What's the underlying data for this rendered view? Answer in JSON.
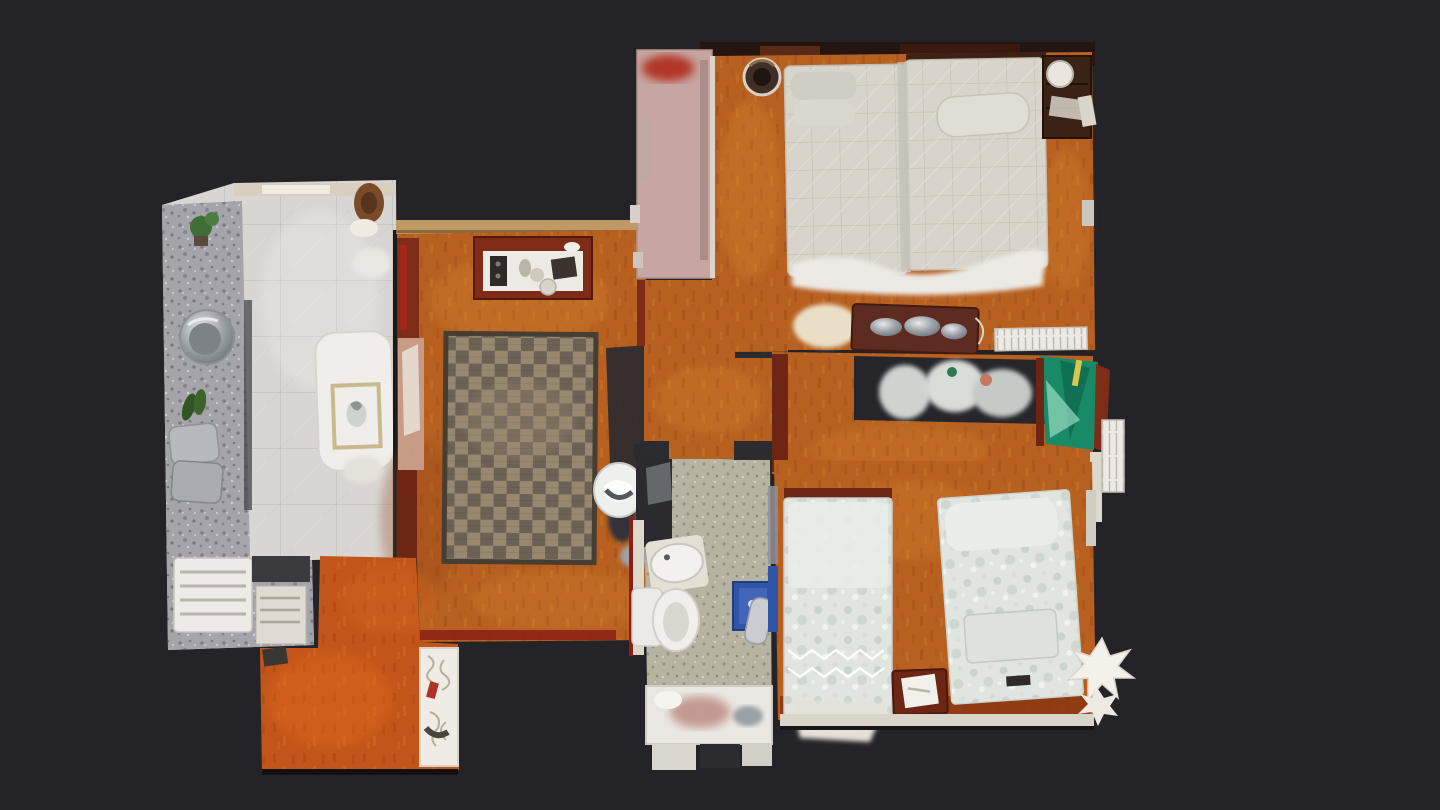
{
  "scene": {
    "kind": "floorplan-top-view"
  },
  "colors": {
    "background": "#242428",
    "shadow_dark": "#2b2b2f",
    "wood_floor": "#b86020",
    "wood_light": "#d88b33",
    "wood_dark": "#8c4212",
    "entry_floor": "#c2561a",
    "kitchen_tile": "#d8d6d3",
    "kitchen_tile_line": "#c4c1bd",
    "terrazzo": "#a4a4aa",
    "terrazzo_dark": "#74747b",
    "terrazzo_light": "#d4d4d9",
    "bath_floor": "#b6b3a0",
    "bath_floor_dark": "#8f8c79",
    "bath_floor_light": "#dcd9c8",
    "rug_light": "#97886f",
    "rug_dark": "#6d6156",
    "rug_border": "#463e33",
    "quilt": "#d8d4cb",
    "quilt_line": "#c2beb3",
    "bedding_floral": "#e1e5df",
    "bedding_spot": "#c3cfc6",
    "sheet_white": "#eceae5",
    "mahogany": "#7e2b17",
    "mahogany_dark": "#54190e",
    "crimson": "#a12818",
    "wall_tan": "#c09a66",
    "wall_white": "#e7e1d4",
    "pink_panel": "#c7a5a0",
    "pink_red": "#b23527",
    "teal_wardrobe": "#188a68",
    "teal_dark": "#0f6b50",
    "teal_light": "#9adbc2",
    "blue_accent": "#2f55a8",
    "fixture_white": "#edebe7",
    "metal_light": "#e8eaec",
    "metal_mid": "#9aa0a5",
    "metal_dark": "#6b7075",
    "plant_green": "#3e6e35",
    "cream": "#eadfc6"
  }
}
